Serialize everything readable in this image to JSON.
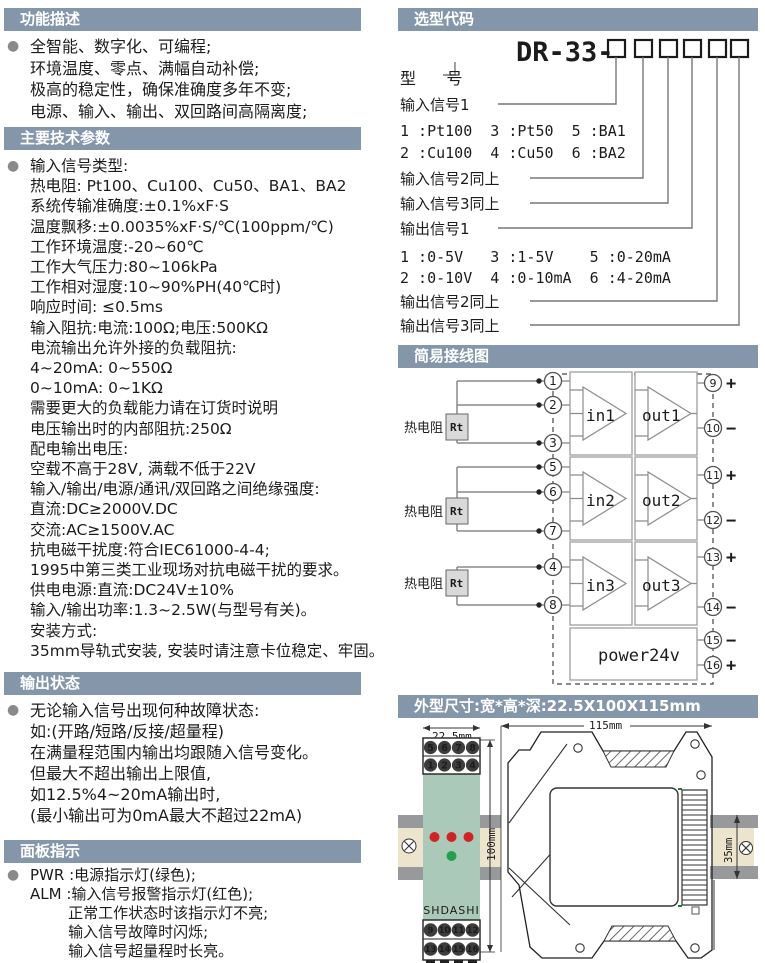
{
  "colors": {
    "header_bg": "#8497aa",
    "model_accent": "#7b91a7",
    "device_body": "#aac9b8",
    "led_red": "#d42222",
    "led_green": "#22a04e",
    "rail_beige": "#ece4cc",
    "rail_gray": "#97999a"
  },
  "left": {
    "sections": [
      {
        "title": "功能描述",
        "lines": [
          "全智能、数字化、可编程;",
          "环境温度、零点、满幅自动补偿;",
          "极高的稳定性，确保准确度多年不变;",
          "电源、输入、输出、双回路间高隔离度;"
        ]
      },
      {
        "title": "主要技术参数",
        "lines": [
          "输入信号类型:",
          "热电阻: Pt100、Cu100、Cu50、BA1、BA2",
          "系统传输准确度:±0.1%xF·S",
          "温度飘移:±0.0035%xF·S/℃(100ppm/℃)",
          "工作环境温度:-20~60℃",
          "工作大气压力:80~106kPa",
          "工作相对湿度:10~90%PH(40℃时)",
          "响应时间: ≤0.5ms",
          "输入阻抗:电流:100Ω;电压:500KΩ",
          "电流输出允许外接的负载阻抗:",
          "4~20mA: 0~550Ω",
          "0~10mA: 0~1KΩ",
          "需要更大的负载能力请在订货时说明",
          "电压输出时的内部阻抗:250Ω",
          "配电输出电压:",
          "空载不高于28V, 满载不低于22V",
          "输入/输出/电源/通讯/双回路之间绝缘强度:",
          "直流:DC≥2000V.DC",
          "交流:AC≥1500V.AC",
          "抗电磁干扰度:符合IEC61000-4-4;",
          "1995中第三类工业现场对抗电磁干扰的要求。",
          "供电电源:直流:DC24V±10%",
          "输入/输出功率:1.3~2.5W(与型号有关)。",
          "安装方式:",
          "35mm导轨式安装, 安装时请注意卡位稳定、牢固。"
        ]
      },
      {
        "title": "输出状态",
        "lines": [
          "无论输入信号出现何种故障状态:",
          "如:(开路/短路/反接/超量程)",
          "在满量程范围内输出均跟随入信号变化。",
          "但最大不超出输出上限值,",
          "如12.5%4~20mA输出时,",
          "(最小输出可为0mA最大不超过22mA)"
        ]
      },
      {
        "title": "面板指示",
        "lines": [
          "PWR :电源指示灯(绿色);",
          "ALM :输入信号报警指示灯(红色);",
          "        正常工作状态时该指示灯不亮;",
          "        输入信号故障时闪烁;",
          "        输入信号超量程时长亮。"
        ]
      }
    ]
  },
  "selection": {
    "title": "选型代码",
    "code": "DR-33-",
    "rows": {
      "model": "型      号",
      "in1": "输入信号1",
      "in1_a": "1 :Pt100  3 :Pt50  5 :BA1",
      "in1_b": "2 :Cu100  4 :Cu50  6 :BA2",
      "in2": "输入信号2同上",
      "in3": "输入信号3同上",
      "out1": "输出信号1",
      "out1_a": "1 :0-5V   3 :1-5V    5 :0-20mA",
      "out1_b": "2 :0-10V  4 :0-10mA  6 :4-20mA",
      "out2": "输出信号2同上",
      "out3": "输出信号3同上"
    }
  },
  "wiring": {
    "title": "简易接线图",
    "rt_label": "热电阻",
    "rt": "Rt",
    "amp_in": [
      "in1",
      "in2",
      "in3"
    ],
    "amp_out": [
      "out1",
      "out2",
      "out3"
    ],
    "power": "power24v",
    "terminals_left": [
      "1",
      "2",
      "3",
      "5",
      "6",
      "7",
      "4",
      "8"
    ],
    "terminals_right": [
      {
        "n": "9",
        "s": "+"
      },
      {
        "n": "10",
        "s": "−"
      },
      {
        "n": "11",
        "s": "+"
      },
      {
        "n": "12",
        "s": "−"
      },
      {
        "n": "13",
        "s": "+"
      },
      {
        "n": "14",
        "s": "−"
      },
      {
        "n": "15",
        "s": "−"
      },
      {
        "n": "16",
        "s": "+"
      }
    ]
  },
  "dims": {
    "title": "外型尺寸:宽*高*深:22.5X100X115mm",
    "width": "22.5mm",
    "height": "100mm",
    "depth": "115mm",
    "rail": "35mm",
    "brand": "SHDASHI",
    "front_top_row1": [
      "5",
      "6",
      "7",
      "8"
    ],
    "front_top_row2": [
      "1",
      "2",
      "3",
      "4"
    ],
    "front_bottom_row1": [
      "9",
      "10",
      "11",
      "12"
    ],
    "front_bottom_row2": [
      "13",
      "14",
      "15",
      "16"
    ]
  }
}
